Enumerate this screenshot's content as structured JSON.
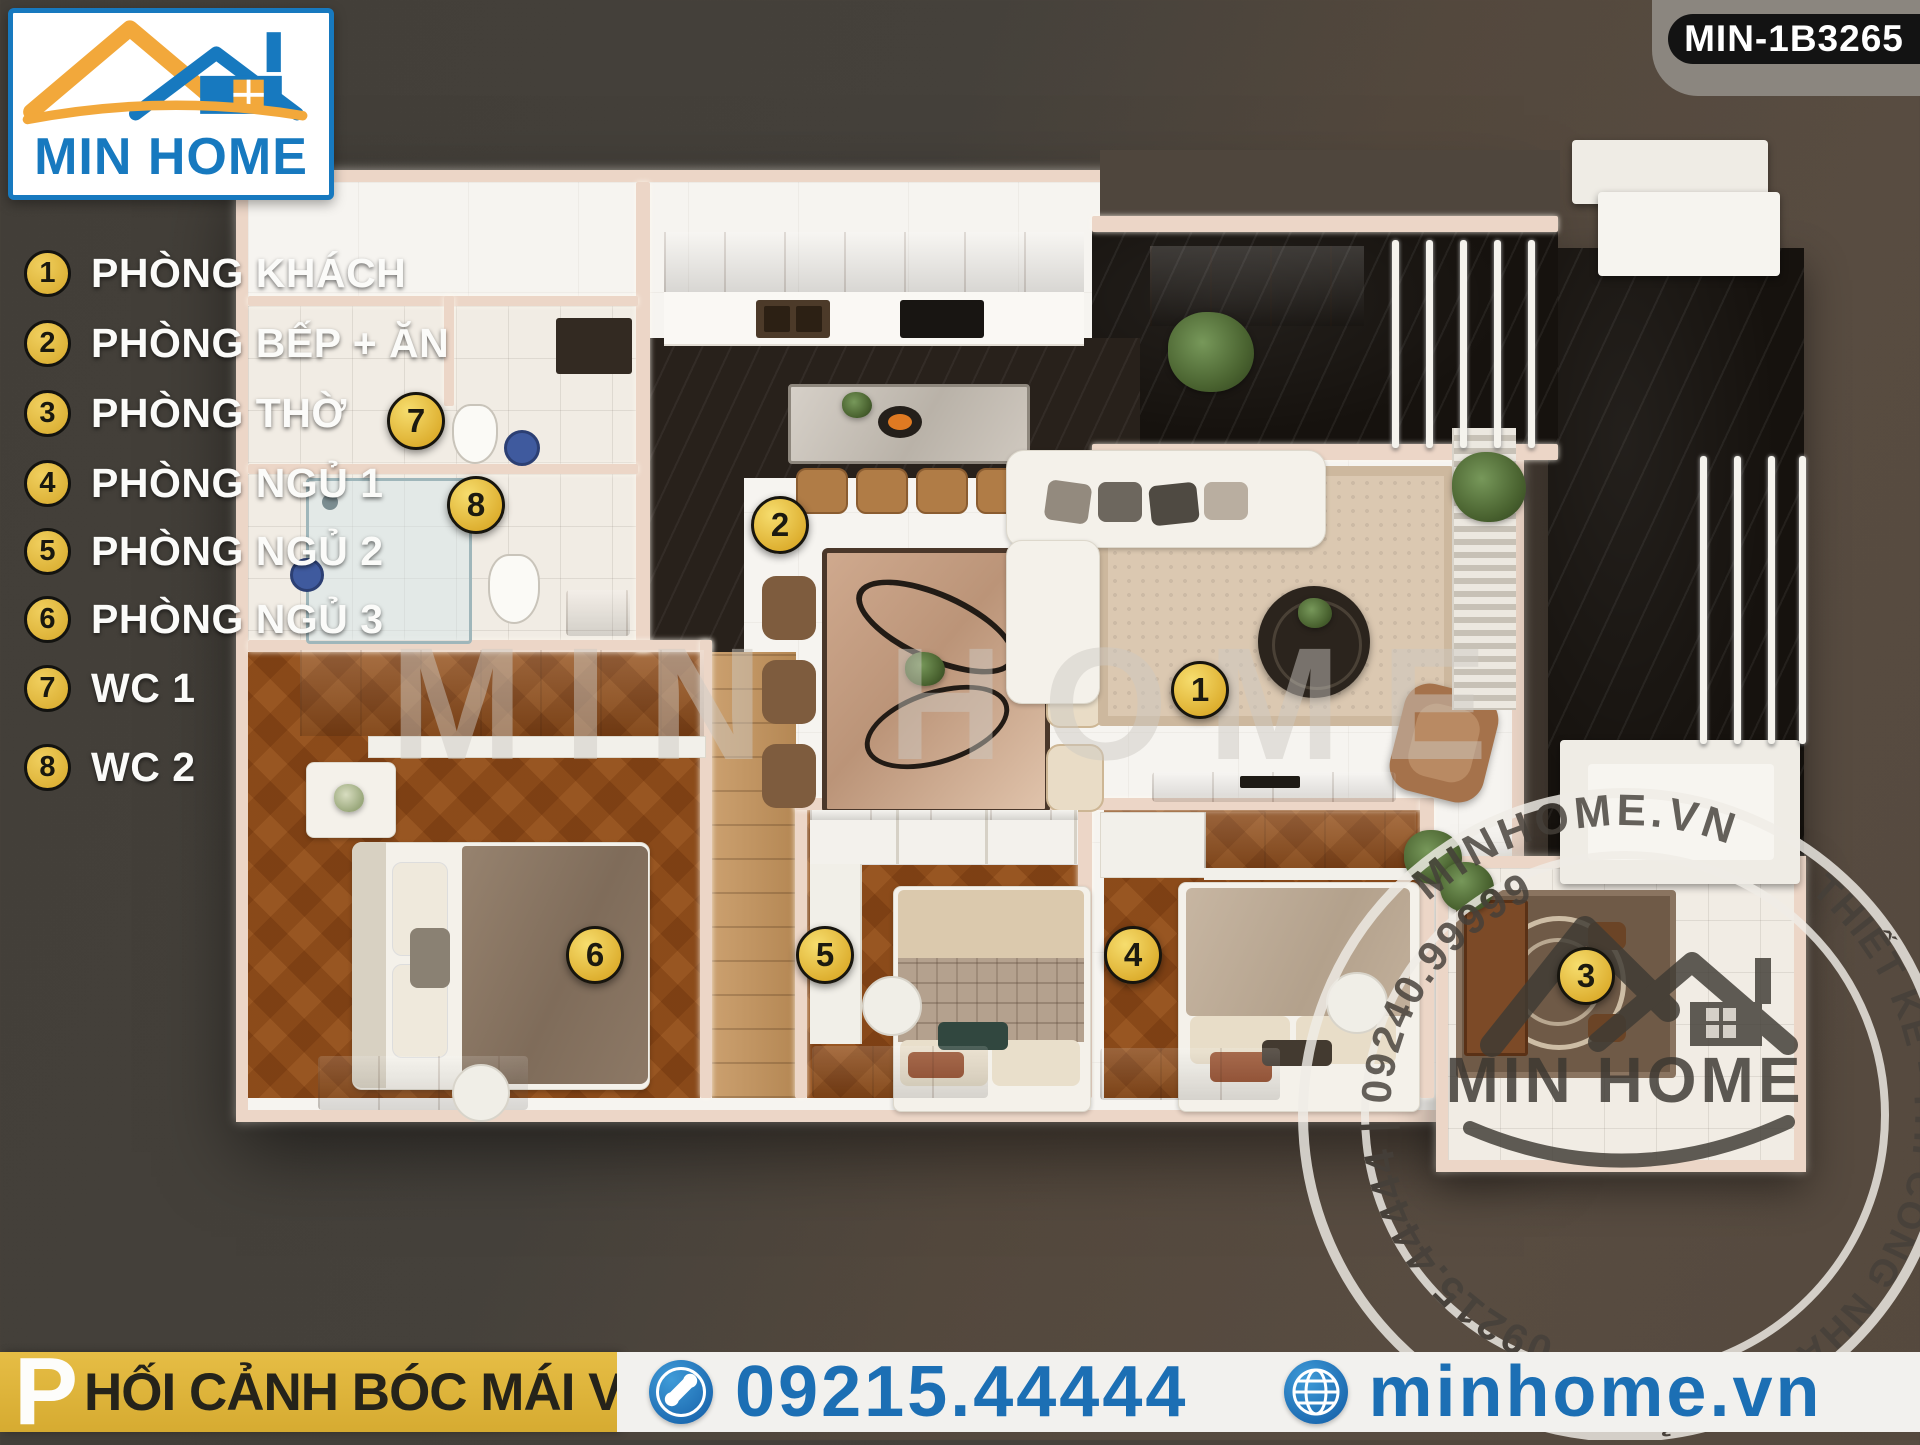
{
  "header": {
    "logo_text": "MIN HOME",
    "badge": "MIN-1B3265"
  },
  "legend": {
    "items": [
      {
        "num": "1",
        "label": "PHÒNG KHÁCH"
      },
      {
        "num": "2",
        "label": "PHÒNG BẾP + ĂN"
      },
      {
        "num": "3",
        "label": "PHÒNG THỜ"
      },
      {
        "num": "4",
        "label": "PHÒNG NGỦ 1"
      },
      {
        "num": "5",
        "label": "PHÒNG NGỦ 2"
      },
      {
        "num": "6",
        "label": "PHÒNG NGỦ 3"
      },
      {
        "num": "7",
        "label": "WC 1"
      },
      {
        "num": "8",
        "label": "WC 2"
      }
    ]
  },
  "markers": [
    {
      "num": "1"
    },
    {
      "num": "2"
    },
    {
      "num": "3"
    },
    {
      "num": "4"
    },
    {
      "num": "5"
    },
    {
      "num": "6"
    },
    {
      "num": "7"
    },
    {
      "num": "8"
    }
  ],
  "watermark": {
    "center_text": "MIN HOME",
    "stamp_top": "MINHOME.VN",
    "stamp_right": "THIẾT KẾ - THI CÔNG NHÀ GIÁ RẺ",
    "stamp_left": "09215.44444 | 09240.99999",
    "stamp_logo": "MIN HOME"
  },
  "footer": {
    "caption_initial": "P",
    "caption_rest": "HỐI CẢNH BÓC MÁI VIEW 1",
    "phone": "09215.44444",
    "website": "minhome.vn"
  },
  "colors": {
    "accent_blue": "#1c6fb4",
    "accent_yellow": "#ddb23f",
    "marker_yellow": "#e9c13f",
    "background": "#49443d",
    "wall": "#ecd6c7",
    "wood": "#b5854f",
    "black_marble": "#16120e"
  }
}
